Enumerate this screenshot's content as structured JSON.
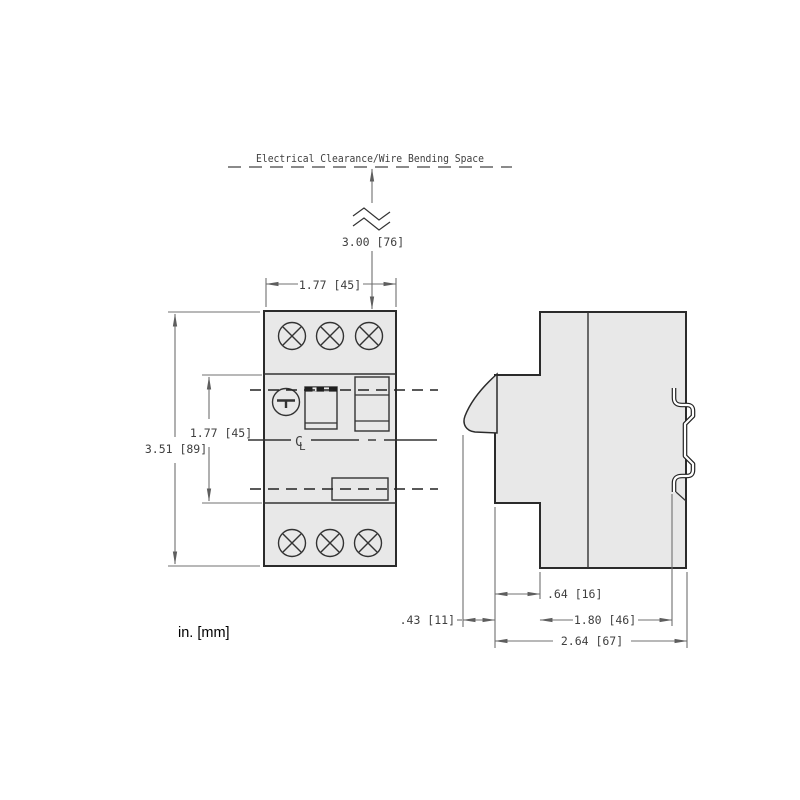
{
  "title": "Electrical Clearance/Wire Bending Space",
  "units_note": "in. [mm]",
  "centerline_symbol": {
    "c": "C",
    "l": "L"
  },
  "colors": {
    "body_fill": "#e8e8e8",
    "outline": "#2b2b2b",
    "dimension_lines": "#707070",
    "text": "#3f3f3f"
  },
  "dims": {
    "clearance_space": "3.00 [76]",
    "front_width": "1.77 [45]",
    "handle_section_height": "1.77 [45]",
    "front_height": "3.51 [89]",
    "step_depth": ".64 [16]",
    "knob_protrusion": ".43 [11]",
    "rail_to_front": "1.80 [46]",
    "total_depth": "2.64 [67]"
  }
}
